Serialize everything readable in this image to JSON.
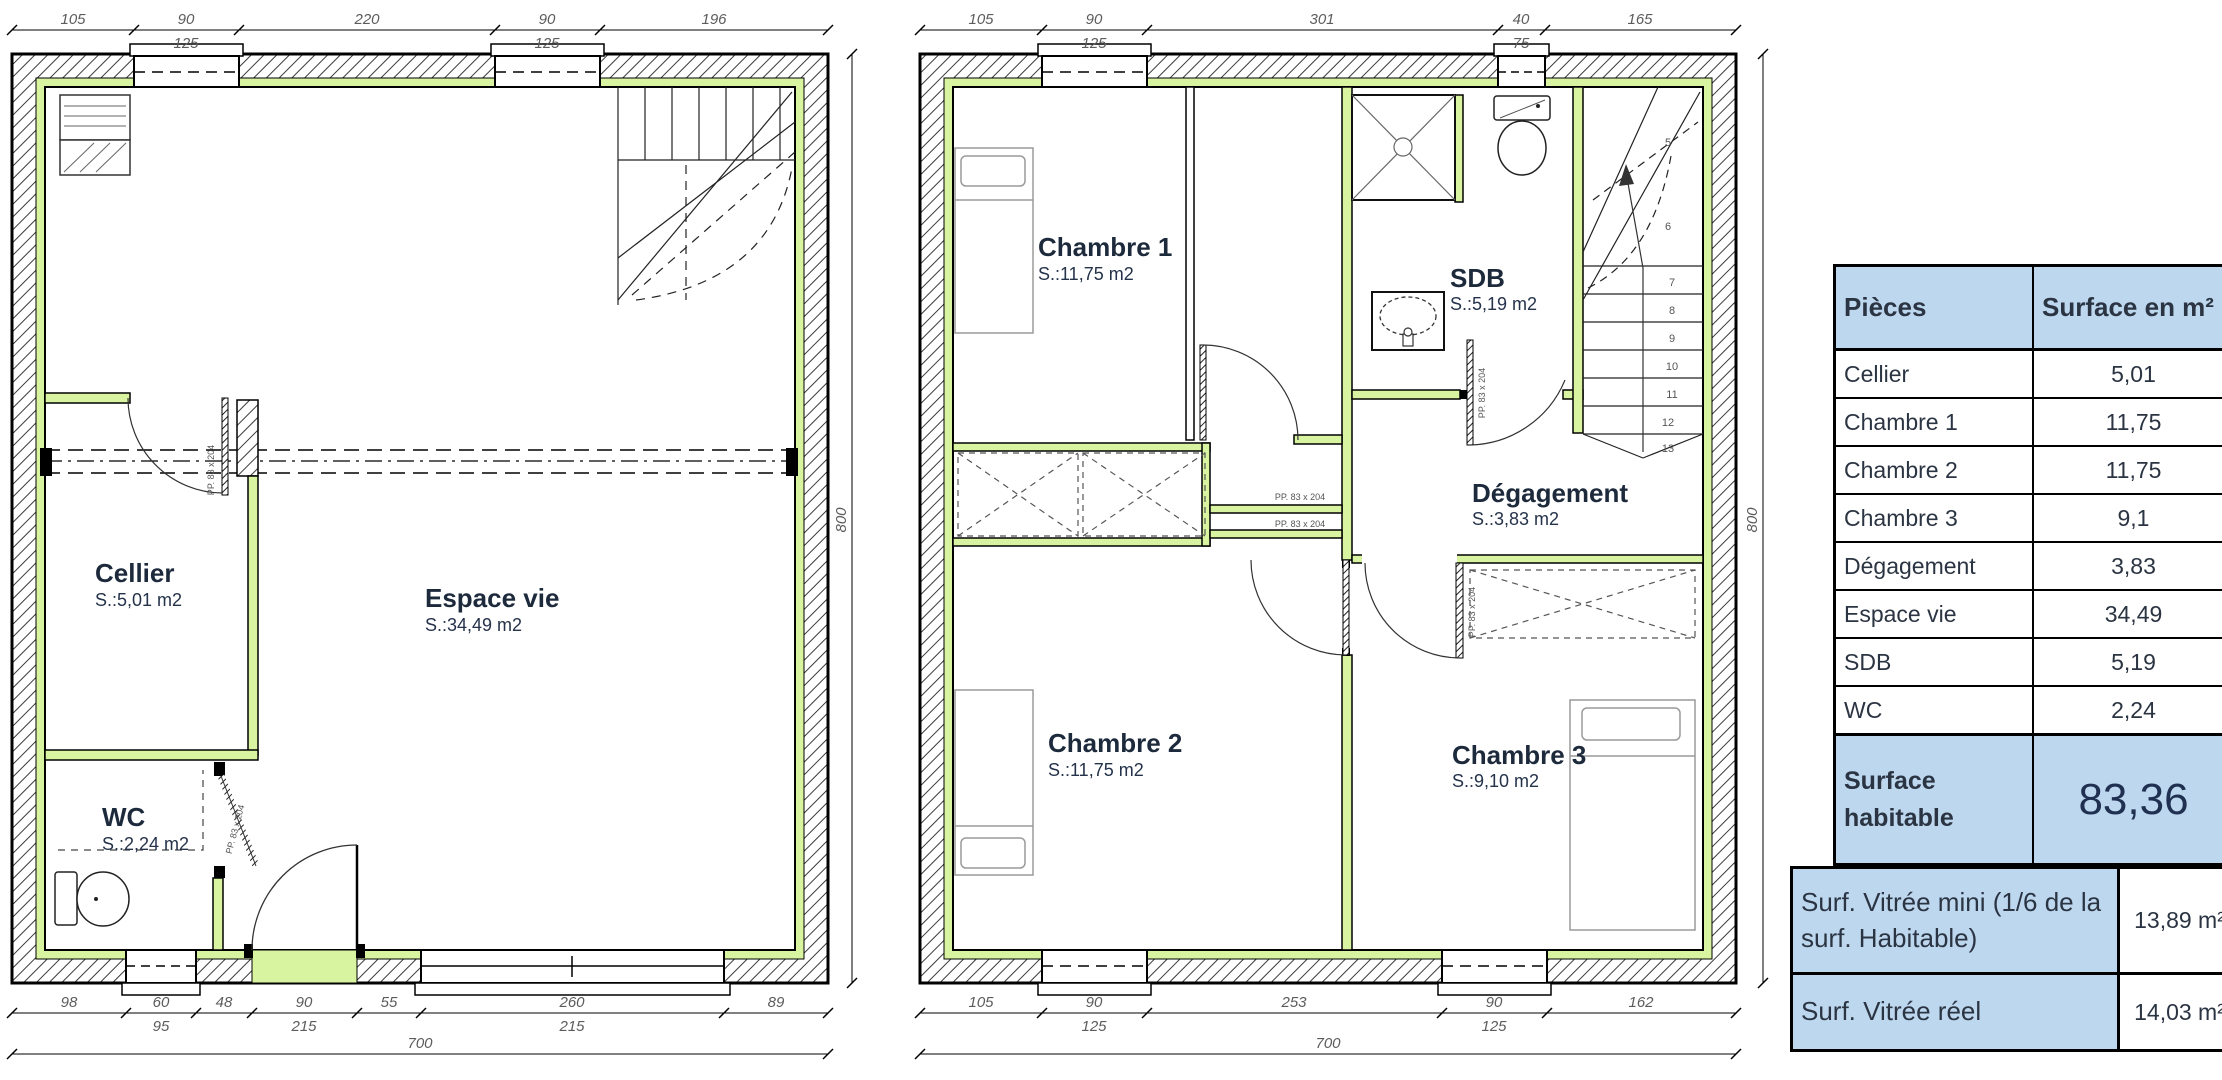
{
  "plans": {
    "door_label": "PP. 83 x 204",
    "ground": {
      "rooms": {
        "cellier": {
          "name": "Cellier",
          "area": "S.:5,01 m2"
        },
        "espace_vie": {
          "name": "Espace vie",
          "area": "S.:34,49 m2"
        },
        "wc": {
          "name": "WC",
          "area": "S.:2,24 m2"
        }
      },
      "dims": {
        "top": [
          "105",
          "90",
          "220",
          "90",
          "196"
        ],
        "top_sub": [
          "125",
          "125"
        ],
        "bottom": [
          "98",
          "60",
          "48",
          "90",
          "55",
          "260",
          "89"
        ],
        "bottom_sub": [
          "95",
          "215",
          "215"
        ],
        "total": "700",
        "height": "800"
      }
    },
    "upper": {
      "rooms": {
        "chambre1": {
          "name": "Chambre 1",
          "area": "S.:11,75 m2"
        },
        "sdb": {
          "name": "SDB",
          "area": "S.:5,19 m2"
        },
        "degagement": {
          "name": "Dégagement",
          "area": "S.:3,83 m2"
        },
        "chambre2": {
          "name": "Chambre 2",
          "area": "S.:11,75 m2"
        },
        "chambre3": {
          "name": "Chambre 3",
          "area": "S.:9,10 m2"
        }
      },
      "dims": {
        "top": [
          "105",
          "90",
          "301",
          "40",
          "165"
        ],
        "top_sub": [
          "125",
          "75"
        ],
        "bottom": [
          "105",
          "90",
          "253",
          "90",
          "162"
        ],
        "bottom_sub": [
          "125",
          "125"
        ],
        "total": "700",
        "height": "800"
      },
      "stair_numbers": [
        "5",
        "6",
        "7",
        "8",
        "9",
        "10",
        "11",
        "12",
        "13"
      ]
    }
  },
  "surface_table": {
    "headers": {
      "col1": "Pièces",
      "col2": "Surface en m²"
    },
    "rows": [
      {
        "label": "Cellier",
        "value": "5,01"
      },
      {
        "label": "Chambre 1",
        "value": "11,75"
      },
      {
        "label": "Chambre 2",
        "value": "11,75"
      },
      {
        "label": "Chambre 3",
        "value": "9,1"
      },
      {
        "label": "Dégagement",
        "value": "3,83"
      },
      {
        "label": "Espace vie",
        "value": "34,49"
      },
      {
        "label": "SDB",
        "value": "5,19"
      },
      {
        "label": "WC",
        "value": "2,24"
      }
    ],
    "total": {
      "label": "Surface habitable",
      "value": "83,36"
    }
  },
  "glazing_table": {
    "rows": [
      {
        "label": "Surf. Vitrée mini (1/6 de la surf. Habitable)",
        "value": "13,89 m²"
      },
      {
        "label": "Surf. Vitrée réel",
        "value": "14,03 m²"
      }
    ]
  },
  "colors": {
    "header_blue": "#bdd7ee",
    "wall_green": "#d9f4a0"
  }
}
